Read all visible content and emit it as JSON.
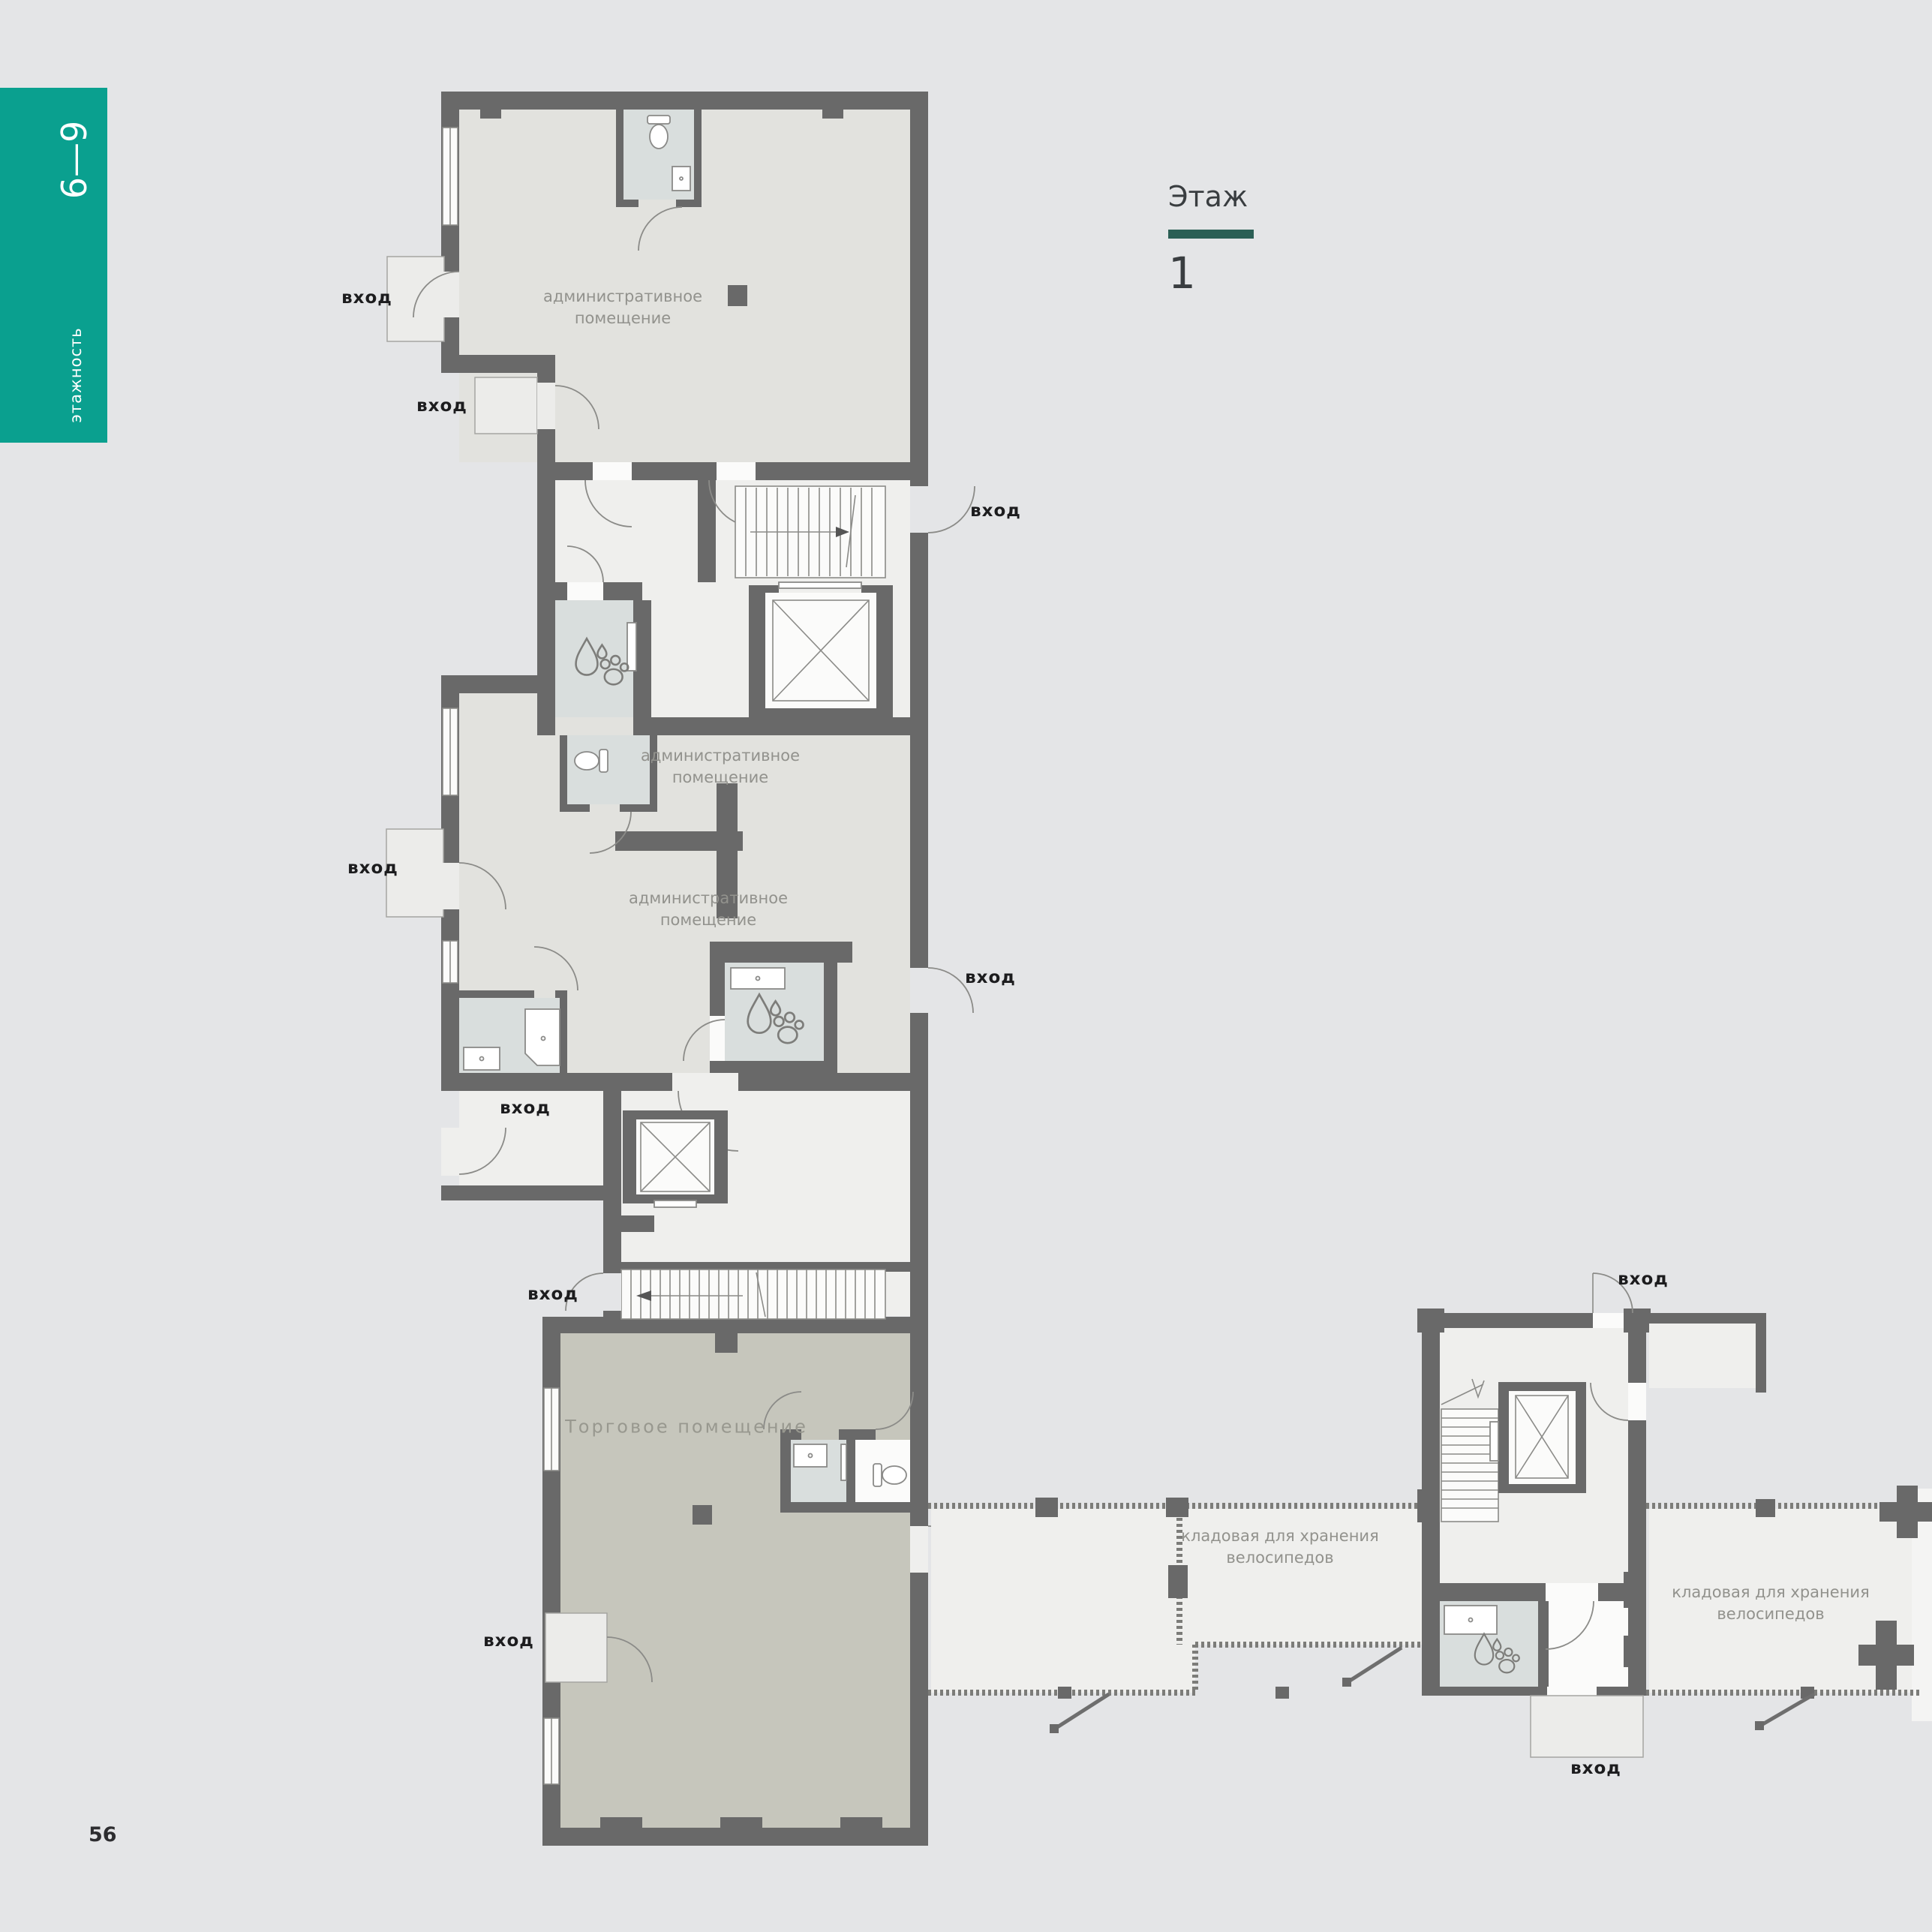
{
  "page": {
    "number": "56"
  },
  "sidebar_tab": {
    "floors_range": "6—9",
    "label": "этажность",
    "color": "#0aa08f"
  },
  "floor_header": {
    "title": "Этаж",
    "number": "1",
    "underline_color": "#2b5f55"
  },
  "colors": {
    "background": "#e4e5e7",
    "wall": "#696969",
    "admin_room_fill": "#e2e2de",
    "hall_fill": "#efefed",
    "wet_room_fill": "#d9dedd",
    "retail_fill": "#c6c6bc",
    "entrance_text": "#1c1c1e",
    "room_label_text": "#92928d"
  },
  "floor_plan": {
    "entrances": [
      {
        "label": "вход"
      },
      {
        "label": "вход"
      },
      {
        "label": "вход"
      },
      {
        "label": "вход"
      },
      {
        "label": "вход"
      },
      {
        "label": "вход"
      },
      {
        "label": "вход"
      },
      {
        "label": "вход"
      },
      {
        "label": "вход"
      },
      {
        "label": "вход"
      }
    ],
    "room_labels": [
      {
        "id": "admin-top",
        "text": "административное помещение"
      },
      {
        "id": "admin-middle-upper",
        "text": "административное помещение"
      },
      {
        "id": "admin-middle-lower",
        "text": "административное помещение"
      },
      {
        "id": "retail",
        "text": "Торговое помещение"
      },
      {
        "id": "bike-storage-left",
        "text": "кладовая для хранения велосипедов"
      },
      {
        "id": "bike-storage-right",
        "text": "кладовая для хранения велосипедов"
      }
    ]
  }
}
